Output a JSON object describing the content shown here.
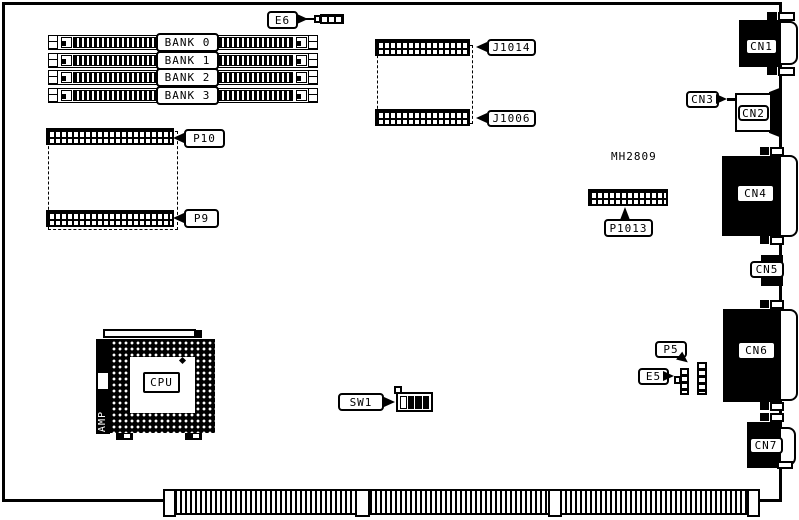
{
  "diagram_type": "motherboard component layout",
  "memory_banks": [
    "BANK 0",
    "BANK 1",
    "BANK 2",
    "BANK 3"
  ],
  "headers": {
    "j1014": "J1014",
    "j1006": "J1006",
    "p10": "P10",
    "p9": "P9",
    "p1013": "P1013"
  },
  "jumpers": {
    "e6": "E6",
    "e5": "E5",
    "p5": "P5"
  },
  "switches": {
    "sw1": "SW1"
  },
  "rear_connectors": {
    "cn1": "CN1",
    "cn2": "CN2",
    "cn3": "CN3",
    "cn4": "CN4",
    "cn5": "CN5",
    "cn6": "CN6",
    "cn7": "CN7"
  },
  "chips": {
    "cpu": "CPU",
    "socket_brand": "AMP",
    "mh2809": "MH2809"
  },
  "colors": {
    "line": "#000000",
    "background": "#ffffff"
  }
}
